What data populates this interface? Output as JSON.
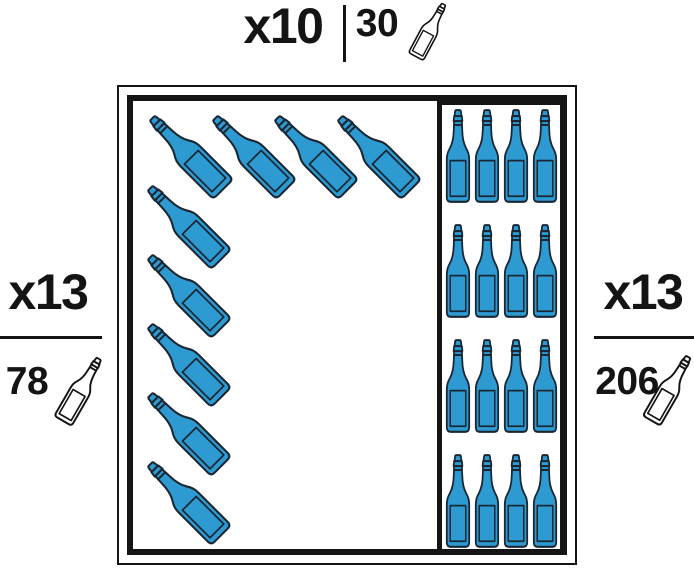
{
  "colors": {
    "ink": "#141414",
    "bottle_blue": "#2D9BD2",
    "bottle_outline": "#1A2733",
    "icon_fill": "#FFFFFF",
    "background": "#FFFFFF"
  },
  "labels": {
    "top": {
      "multiplier": "x10",
      "count": "30",
      "icon": "wine-bottle-icon"
    },
    "left": {
      "multiplier": "x13",
      "count": "78",
      "icon": "wine-bottle-icon"
    },
    "right": {
      "multiplier": "x13",
      "count": "206",
      "icon": "wine-bottle-icon"
    }
  },
  "cellar": {
    "left_rack": {
      "bottle_orientation": "tilted-diagonal",
      "top_row_bottles": 4,
      "left_column_bottles": 5,
      "total_bottles": 9
    },
    "right_rack": {
      "bottle_orientation": "upright",
      "rows": 4,
      "columns": 4,
      "total_bottles": 16
    }
  }
}
